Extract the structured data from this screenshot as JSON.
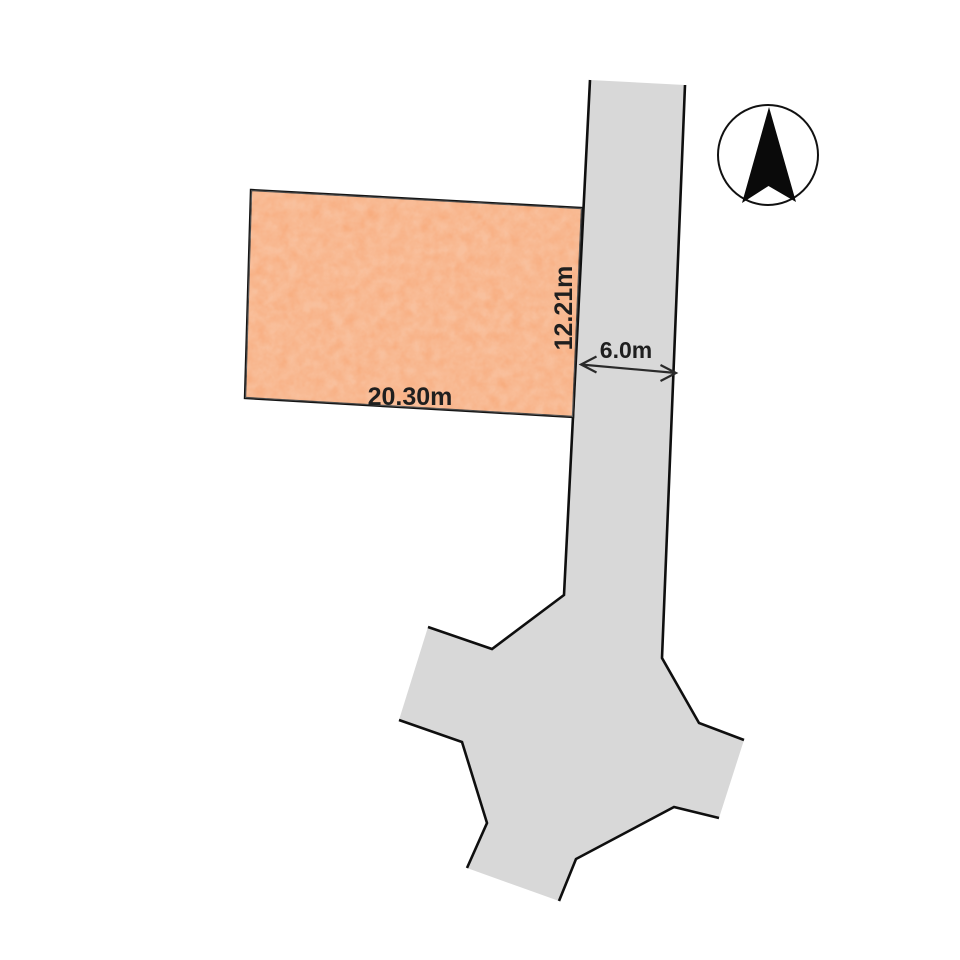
{
  "page": {
    "background_color": "#FFFFFF"
  },
  "plot": {
    "width_label": "20.30m",
    "depth_label": "12.21m",
    "fill_color": "#F6A26E",
    "outline_color": "#141414"
  },
  "road": {
    "width_label": "6.0m",
    "fill_color": "#D8D8D8",
    "outline_color": "#0F0F0F"
  },
  "dimension": {
    "text_color": "#1F1F1F",
    "arrow_color": "#2A2A2A"
  },
  "compass": {
    "icon": "north-arrow",
    "arrow_fill_color": "#0A0A0A",
    "ring_color": "#111111",
    "ring_fill_color": "#FFFFFF"
  }
}
